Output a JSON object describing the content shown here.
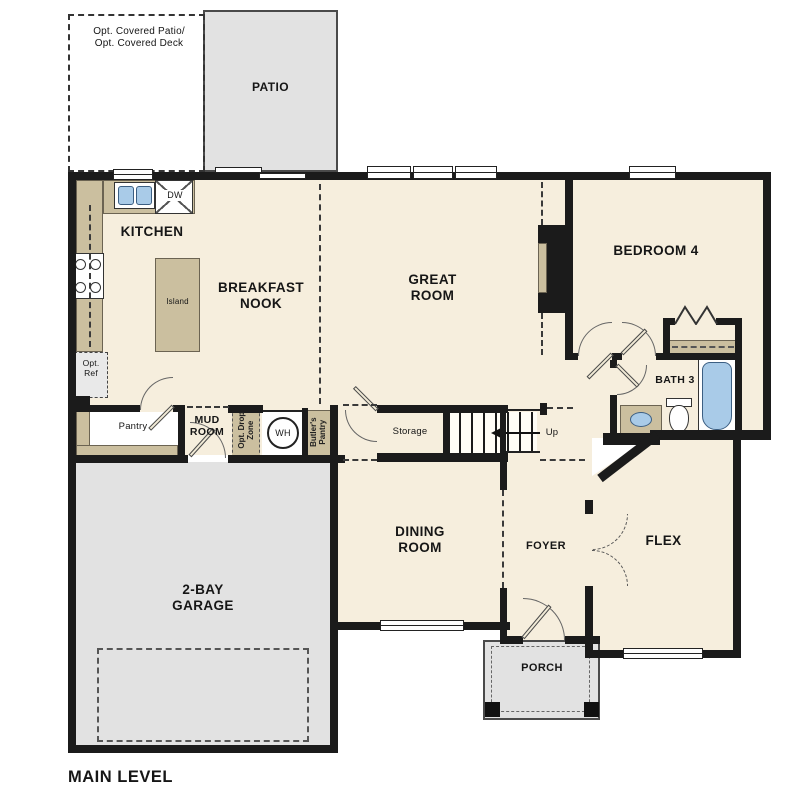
{
  "title": "MAIN LEVEL",
  "colors": {
    "floor": "#f6eedd",
    "concrete_gray": "#e2e2e2",
    "cabinet_tan": "#cbbf9f",
    "fixture_blue": "#a9cbe8",
    "wall_black": "#1b1b1b"
  },
  "labels": {
    "main_level": "MAIN LEVEL",
    "opt_covered": "Opt. Covered Patio/\nOpt. Covered Deck",
    "patio": "PATIO",
    "kitchen": "KITCHEN",
    "dw": "DW",
    "island": "Island",
    "breakfast_nook": "BREAKFAST\nNOOK",
    "great_room": "GREAT\nROOM",
    "bedroom4": "BEDROOM 4",
    "bath3": "BATH 3",
    "opt_ref": "Opt.\nRef",
    "pantry": "Pantry",
    "mud_room": "MUD\nROOM",
    "opt_drop_zone": "Opt. Drop\nZone",
    "wh": "WH",
    "butlers_pantry": "Butler's\nPantry",
    "storage": "Storage",
    "up": "Up",
    "garage": "2-BAY\nGARAGE",
    "dining_room": "DINING\nROOM",
    "foyer": "FOYER",
    "flex": "FLEX",
    "porch": "PORCH"
  }
}
